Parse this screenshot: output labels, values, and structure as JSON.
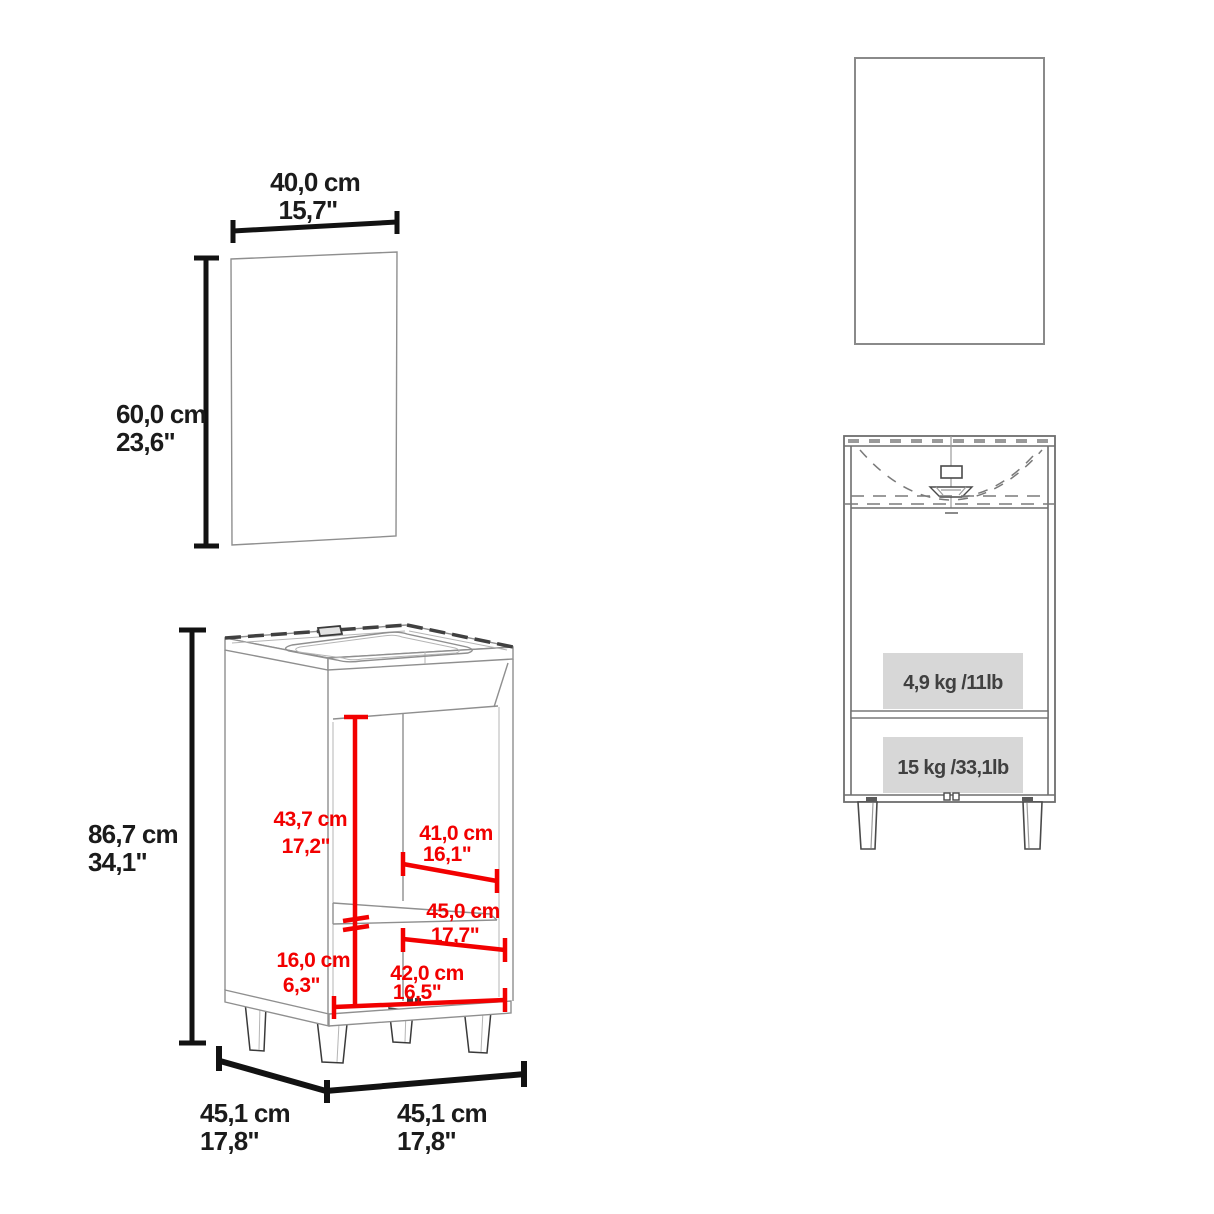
{
  "diagram": {
    "background": "#ffffff",
    "colors": {
      "dimension_text": "#1b1b1b",
      "highlight_red": "#f20000",
      "structure_gray": "#8f8f8f",
      "capacity_panel_fill": "#d7d7d7"
    },
    "mirror_side_view": {
      "width": {
        "cm": "40,0 cm",
        "inches": "15,7\""
      },
      "height": {
        "cm": "60,0 cm",
        "inches": "23,6\""
      }
    },
    "vanity_side_view": {
      "height": {
        "cm": "86,7 cm",
        "inches": "34,1\""
      },
      "depth": {
        "cm": "45,1 cm",
        "inches": "17,8\""
      },
      "width": {
        "cm": "45,1 cm",
        "inches": "17,8\""
      },
      "interior_upper_height": {
        "cm": "43,7 cm",
        "inches": "17,2\""
      },
      "interior_upper_width": {
        "cm": "41,0 cm",
        "inches": "16,1\""
      },
      "shelf_width": {
        "cm": "45,0 cm",
        "inches": "17,7\""
      },
      "interior_lower_height": {
        "cm": "16,0 cm",
        "inches": "6,3\""
      },
      "interior_lower_width": {
        "cm": "42,0 cm",
        "inches": "16,5\""
      }
    },
    "vanity_front_view": {
      "upper_shelf_capacity": "4,9 kg /11lb",
      "lower_shelf_capacity": "15 kg /33,1lb"
    }
  }
}
